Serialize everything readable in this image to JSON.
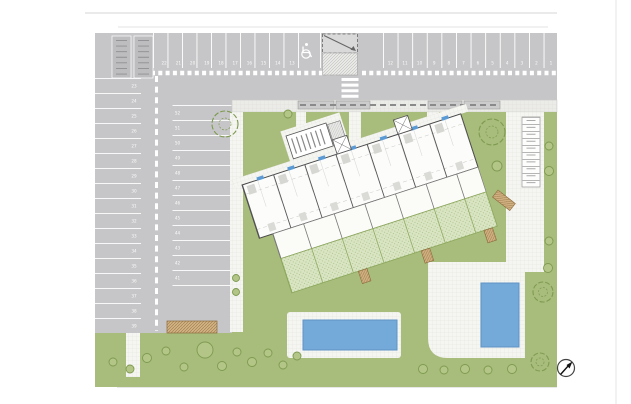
{
  "drawing": {
    "title": "residential site plan",
    "north_arrow_icon": "compass-needle-icon"
  },
  "parking": {
    "top_row_numbers": [
      "1",
      "2",
      "3",
      "4",
      "5",
      "6",
      "7",
      "8",
      "9",
      "10",
      "11",
      "12",
      "13",
      "14",
      "15",
      "16",
      "17",
      "18",
      "19",
      "20",
      "21",
      "22"
    ],
    "left_column_numbers": [
      "23",
      "24",
      "25",
      "26",
      "27",
      "28",
      "29",
      "30",
      "31",
      "32",
      "33",
      "34",
      "35",
      "36",
      "37",
      "38",
      "39"
    ],
    "inner_column_numbers": [
      "52",
      "51",
      "50",
      "49",
      "48",
      "47",
      "46",
      "45",
      "44",
      "43",
      "42",
      "41"
    ],
    "accessible_space_icon": "wheelchair-icon",
    "entrance_ramp_icon": "ramp-arrow-icon"
  },
  "colors": {
    "asphalt": "#c6c6c8",
    "marking": "#ffffff",
    "lawn": "#a8bc7c",
    "shrub": "#7d9a4f",
    "garden": "#d9e4c2",
    "path": "#f4f4f1",
    "sidewalk": "#dcdcdc",
    "building_fill": "#fcfcfb",
    "building_line": "#4a4a4a",
    "roof_unit_blue": "#5b9bd5",
    "pool_water": "#74aad9",
    "pool_edge": "#5e93c4",
    "timber": "#d2b183",
    "boundary_line": "#cfcfcf"
  }
}
